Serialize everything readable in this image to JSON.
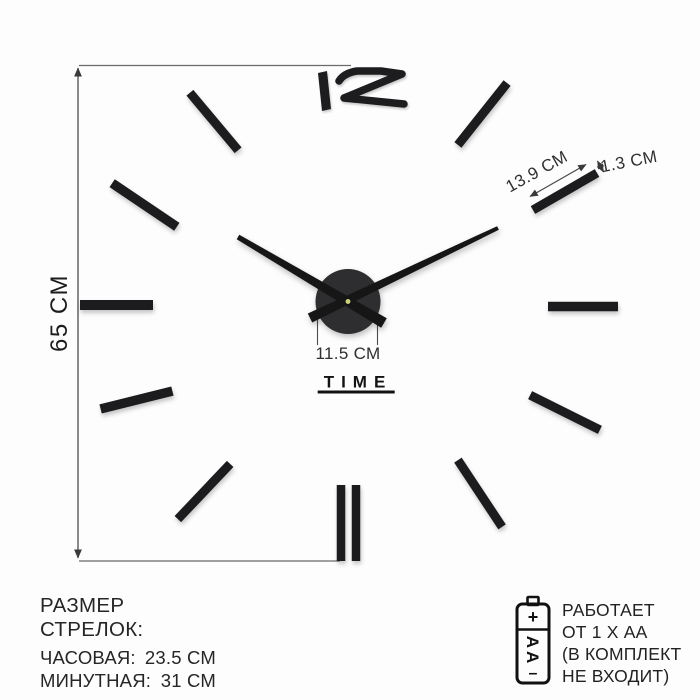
{
  "product": {
    "clock": {
      "top_numeral": "12",
      "brand_text": "TIME"
    },
    "measurements": {
      "height_label": "65 СМ",
      "marker_length_label": "13.9 СМ",
      "marker_width_label": "1.3 СМ",
      "hub_width_label": "11.5 СМ"
    },
    "hand_sizes": {
      "title": "РАЗМЕР СТРЕЛОК:",
      "rows": [
        {
          "label": "ЧАСОВАЯ:",
          "value": "23.5 СМ"
        },
        {
          "label": "МИНУТНАЯ:",
          "value": "31 СМ"
        }
      ]
    },
    "battery": {
      "cell_label": "АА",
      "plus_sign": "+",
      "minus_sign": "–",
      "lines": [
        "РАБОТАЕТ",
        "ОТ 1 Х АА",
        "(В КОМПЛЕКТ",
        "НЕ ВХОДИТ)"
      ]
    },
    "colors": {
      "marker": "#1c1c1e",
      "hand": "#161617",
      "hub": "#2e2e30",
      "center_pin": "#c9cf7c",
      "measure_line": "#5f5f5f",
      "text": "#242424",
      "background": "#fdfdfd"
    }
  }
}
